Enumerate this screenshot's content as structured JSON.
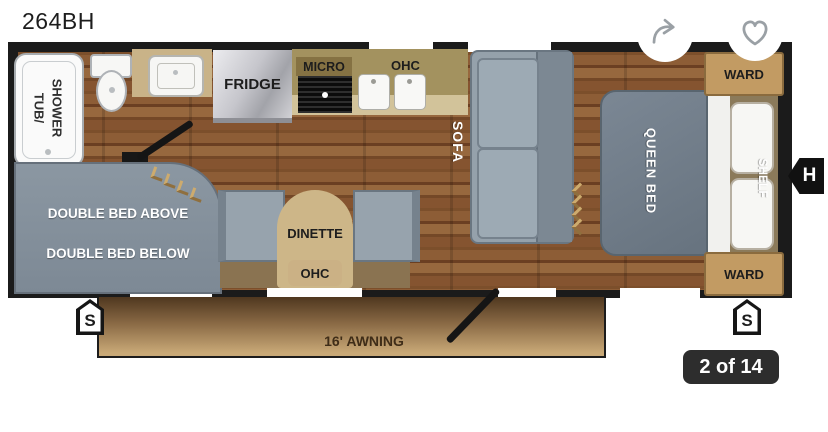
{
  "header": {
    "title": "264BH"
  },
  "gallery": {
    "counter": "2 of 14"
  },
  "floorplan": {
    "bathroom": {
      "tub_line1": "TUB/",
      "tub_line2": "SHOWER"
    },
    "kitchen": {
      "fridge": "FRIDGE",
      "micro": "MICRO",
      "ohc": "OHC"
    },
    "living": {
      "sofa": "SOFA",
      "dinette": "DINETTE",
      "dinette_ohc": "OHC"
    },
    "bedroom": {
      "queen_bed": "QUEEN BED",
      "shelf": "SHELF",
      "ward_top": "WARD",
      "ward_bottom": "WARD"
    },
    "bunk": {
      "above": "DOUBLE BED ABOVE",
      "below": "DOUBLE BED BELOW"
    },
    "exterior": {
      "awning": "16' AWNING",
      "stab_left": "S",
      "stab_right": "S",
      "hitch": "H"
    }
  },
  "icons": {
    "share": "share-icon",
    "favorite": "heart-icon"
  },
  "palette": {
    "furnitureGray": "#95a1ab",
    "wardTan": "#c29b63",
    "awningTan": "#8a6a45",
    "badgeDark": "#2d2d2d",
    "iconGray": "#9aa0a5",
    "wallBlack": "#1b1b1b",
    "woodBrown": "#7f5230",
    "counterTan": "#a3925f"
  }
}
